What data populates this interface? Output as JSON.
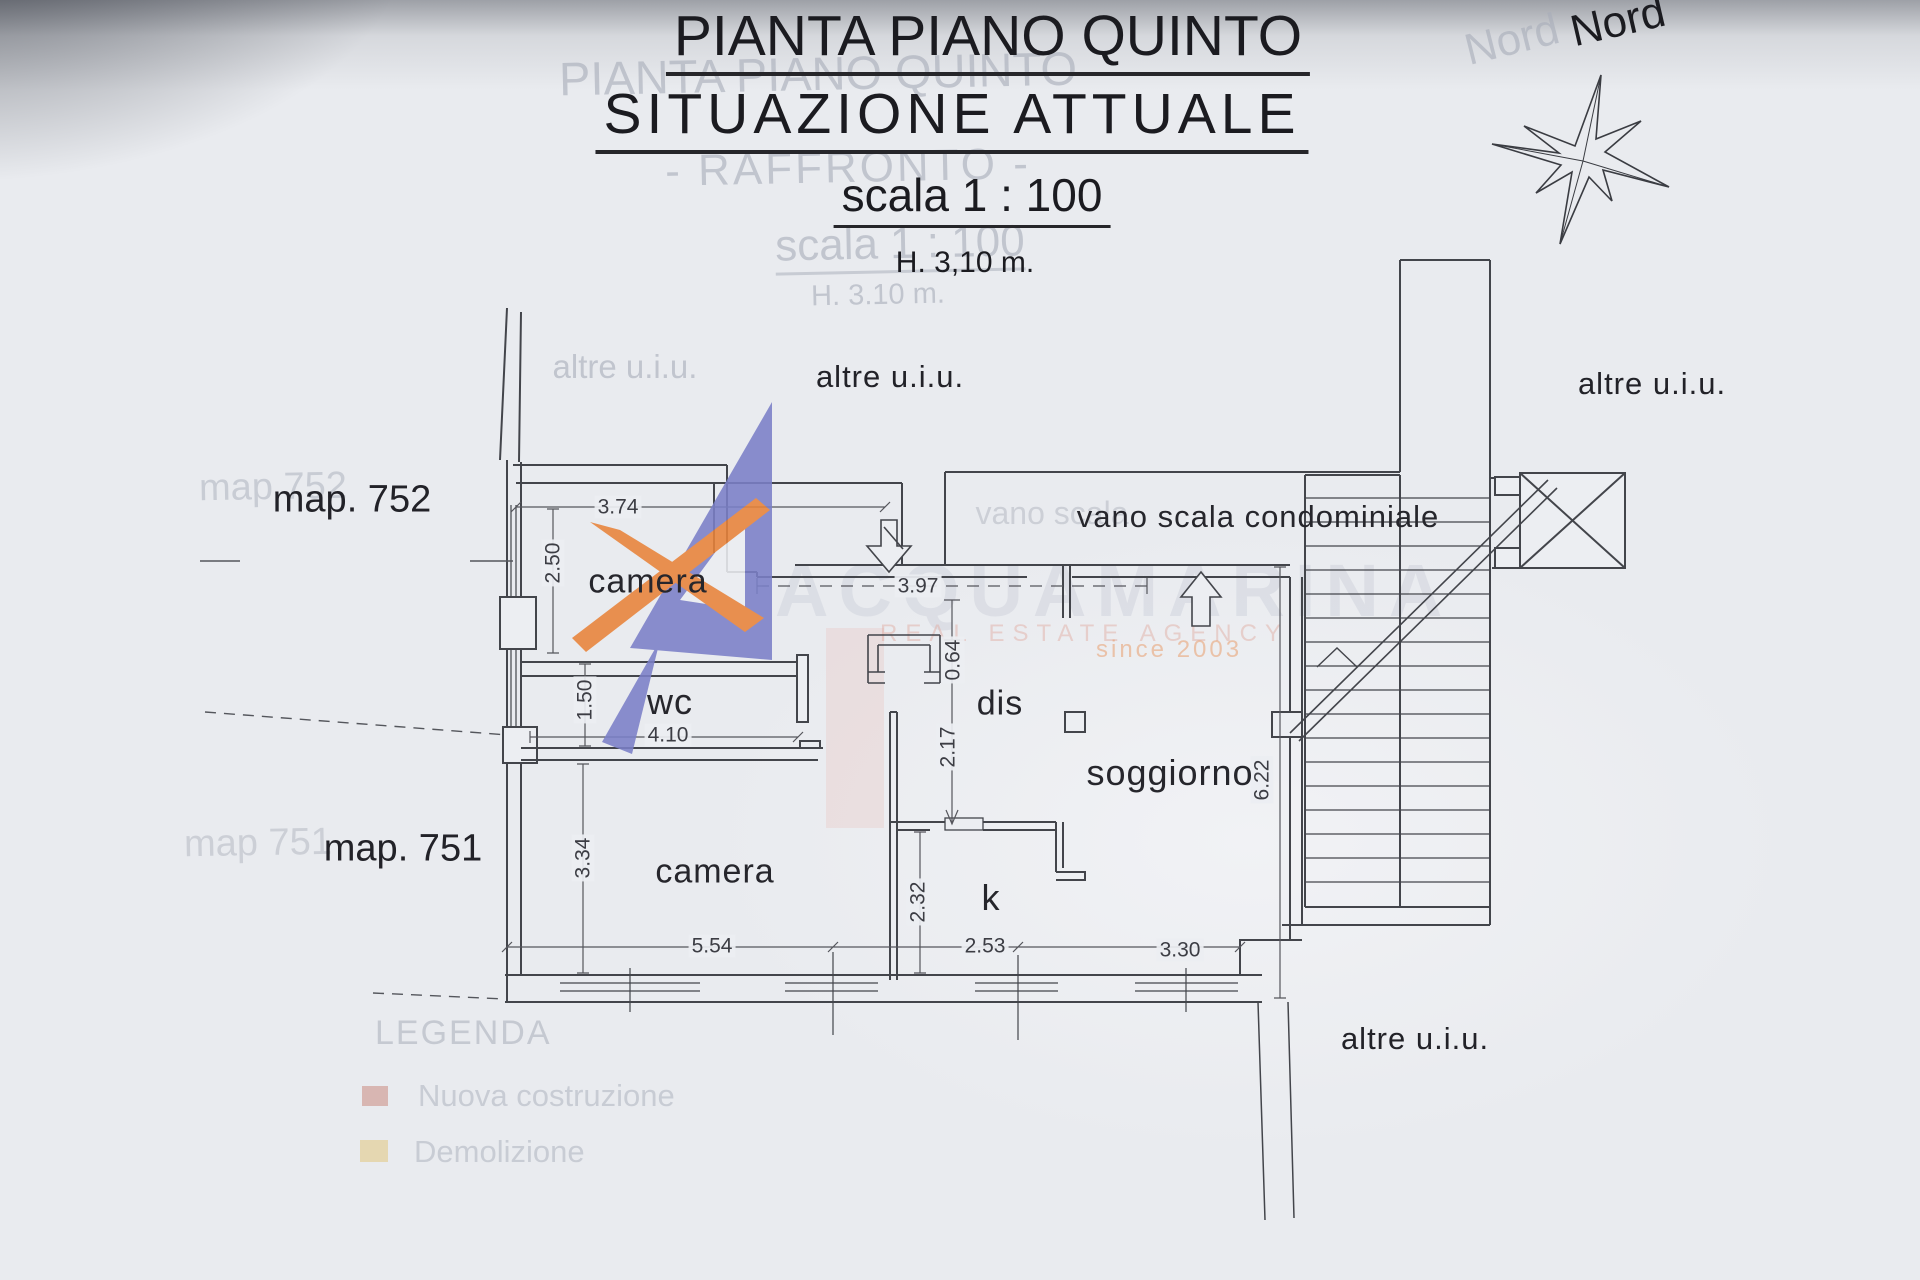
{
  "titles": {
    "l1": "PIANTA PIANO QUINTO",
    "l2": "SITUAZIONE ATTUALE",
    "l3": "scala 1 : 100",
    "l4": "H. 3,10 m."
  },
  "compass": {
    "label": "Nord"
  },
  "areas": {
    "altre": "altre u.i.u.",
    "map752": "map. 752",
    "map751": "map. 751"
  },
  "rooms": {
    "camera_top": "camera",
    "wc": "wc",
    "dis": "dis",
    "soggiorno": "soggiorno",
    "camera_bottom": "camera",
    "kitchen": "k",
    "vano_scala": "vano scala condominiale"
  },
  "dims": {
    "d374": "3.74",
    "d250": "2.50",
    "d150": "1.50",
    "d410": "4.10",
    "d334": "3.34",
    "d554": "5.54",
    "d253": "2.53",
    "d330": "3.30",
    "d397": "3.97",
    "d064": "0.64",
    "d217": "2.17",
    "d232": "2.32",
    "d622": "6.22"
  },
  "ghosts": {
    "title1": "PIANTA PIANO QUINTO",
    "raffronto": "- RAFFRONTO -",
    "scala": "scala 1 : 100",
    "height": "H. 3.10 m.",
    "nord": "Nord",
    "altre": "altre u.i.u.",
    "vano": "vano scala",
    "map752": "map 752",
    "map751": "map 751",
    "legend_title": "LEGENDA",
    "legend_item1": "Nuova costruzione",
    "legend_item2": "Demolizione"
  },
  "watermark": {
    "brand": "ACQUAMARINA",
    "tagline": "REAL ESTATE AGENCY",
    "since": "since 2003"
  },
  "colors": {
    "logo_orange": "#e8833a",
    "logo_blue": "#7b80c8",
    "paper": "#eceef2",
    "line": "#43454b"
  }
}
